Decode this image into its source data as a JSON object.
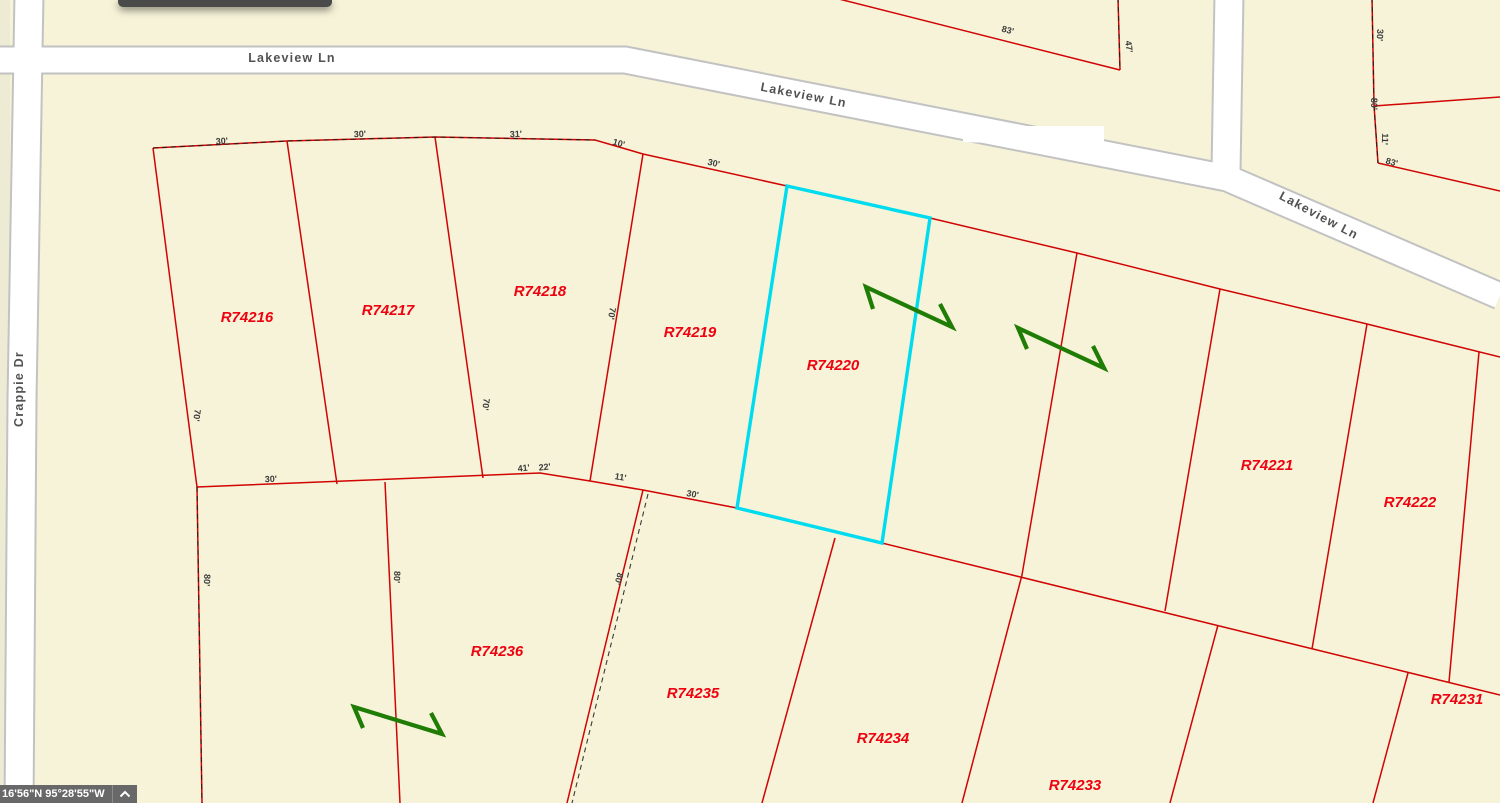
{
  "statusbar": {
    "coordinates": "16'56\"N 95°28'55\"W"
  },
  "streets": [
    {
      "name": "Lakeview Ln",
      "x": 292,
      "y": 62,
      "rot": 0
    },
    {
      "name": "Lakeview Ln",
      "x": 803,
      "y": 99,
      "rot": 11
    },
    {
      "name": "Lakeview Ln",
      "x": 1317,
      "y": 219,
      "rot": 28
    },
    {
      "name": "Crappie Dr",
      "x": 23,
      "y": 389,
      "rot": -90
    }
  ],
  "parcels": [
    {
      "id": "R74216",
      "x": 247,
      "y": 322,
      "selected": false
    },
    {
      "id": "R74217",
      "x": 388,
      "y": 315,
      "selected": false
    },
    {
      "id": "R74218",
      "x": 540,
      "y": 296,
      "selected": false
    },
    {
      "id": "R74219",
      "x": 690,
      "y": 337,
      "selected": false
    },
    {
      "id": "R74220",
      "x": 833,
      "y": 370,
      "selected": true
    },
    {
      "id": "R74221",
      "x": 1267,
      "y": 470,
      "selected": false
    },
    {
      "id": "R74222",
      "x": 1410,
      "y": 507,
      "selected": false
    },
    {
      "id": "R74236",
      "x": 497,
      "y": 656,
      "selected": false
    },
    {
      "id": "R74235",
      "x": 693,
      "y": 698,
      "selected": false
    },
    {
      "id": "R74234",
      "x": 883,
      "y": 743,
      "selected": false
    },
    {
      "id": "R74233",
      "x": 1075,
      "y": 790,
      "selected": false
    },
    {
      "id": "R74231",
      "x": 1457,
      "y": 704,
      "selected": false
    }
  ],
  "dimensions": [
    {
      "t": "30'",
      "x": 222,
      "y": 144,
      "r": -3
    },
    {
      "t": "30'",
      "x": 360,
      "y": 137,
      "r": -2
    },
    {
      "t": "31'",
      "x": 516,
      "y": 137,
      "r": -2
    },
    {
      "t": "10'",
      "x": 618,
      "y": 146,
      "r": 16
    },
    {
      "t": "30'",
      "x": 713,
      "y": 166,
      "r": 13
    },
    {
      "t": "70'",
      "x": 194,
      "y": 415,
      "r": 97
    },
    {
      "t": "70'",
      "x": 483,
      "y": 404,
      "r": 97
    },
    {
      "t": "70'",
      "x": 609,
      "y": 313,
      "r": 100
    },
    {
      "t": "30'",
      "x": 271,
      "y": 482,
      "r": -2
    },
    {
      "t": "41'",
      "x": 524,
      "y": 471,
      "r": -6
    },
    {
      "t": "22'",
      "x": 545,
      "y": 470,
      "r": -6
    },
    {
      "t": "11'",
      "x": 620,
      "y": 480,
      "r": 10
    },
    {
      "t": "30'",
      "x": 692,
      "y": 497,
      "r": 11
    },
    {
      "t": "80'",
      "x": 204,
      "y": 580,
      "r": 94
    },
    {
      "t": "80'",
      "x": 394,
      "y": 577,
      "r": 92
    },
    {
      "t": "80'",
      "x": 616,
      "y": 578,
      "r": 107
    },
    {
      "t": "83'",
      "x": 1007,
      "y": 33,
      "r": 14
    },
    {
      "t": "47'",
      "x": 1126,
      "y": 47,
      "r": 83
    },
    {
      "t": "30'",
      "x": 1377,
      "y": 35,
      "r": 92
    },
    {
      "t": "80'",
      "x": 1371,
      "y": 104,
      "r": 90
    },
    {
      "t": "11'",
      "x": 1382,
      "y": 139,
      "r": 93
    },
    {
      "t": "83'",
      "x": 1391,
      "y": 165,
      "r": 15
    }
  ],
  "colors": {
    "background_beige": "#f6f3d8",
    "left_strip_beige": "#eeebd5",
    "road_fill": "#ffffff",
    "road_casing": "#c2c2c2",
    "parcel_line_red": "#d10404",
    "parcel_label_red": "#ee0210",
    "selected_outline_cyan": "#00dcef",
    "stream_symbol_green": "#1f7c05",
    "dimension_text": "#3c3c3c",
    "street_text": "#525252",
    "statusbar_bg": "#686868"
  }
}
